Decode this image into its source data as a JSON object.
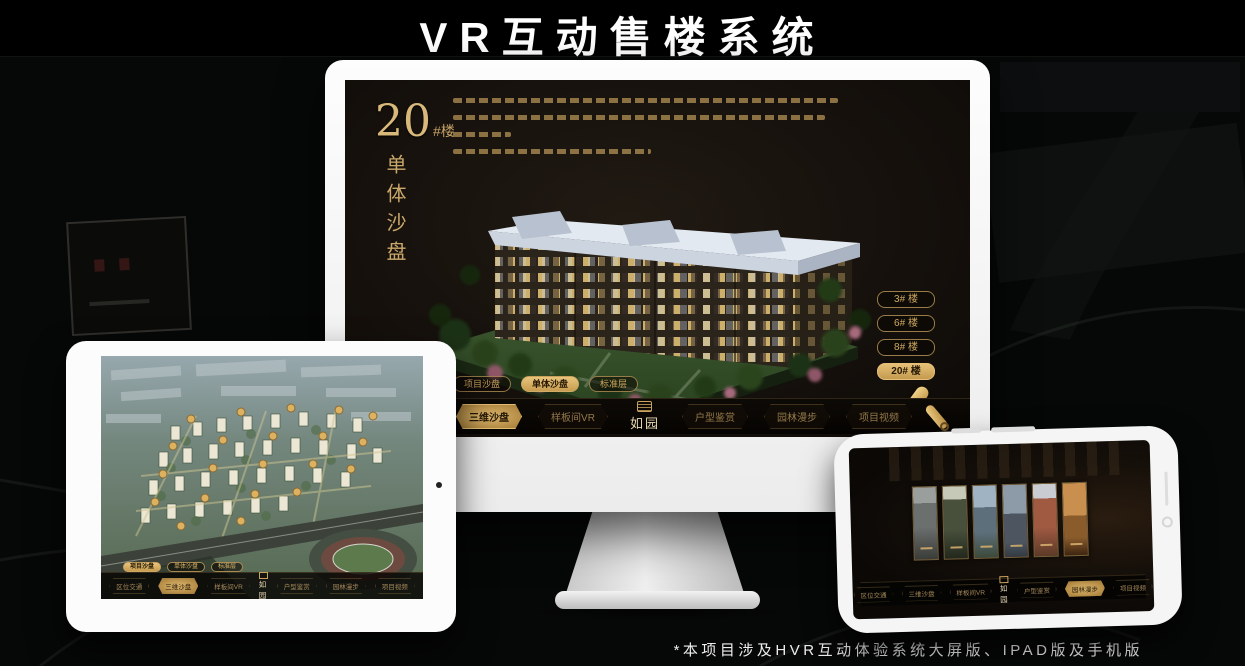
{
  "header": {
    "title": "VR互动售楼系统"
  },
  "footer": {
    "note": "*本项目涉及HVR互动体验系统大屏版、IPAD版及手机版"
  },
  "brand": {
    "logo": "如园",
    "gold": "#c9a35f",
    "screen_bg": "#17120e"
  },
  "nav": {
    "items": [
      "区位交通",
      "三维沙盘",
      "样板间VR",
      "户型鉴赏",
      "园林漫步",
      "项目视频"
    ],
    "scroll_icon": "scroll-collapse"
  },
  "tabs": {
    "items": [
      "项目沙盘",
      "单体沙盘",
      "标准层"
    ]
  },
  "monitor": {
    "heading_number": "20",
    "heading_suffix": "#楼",
    "heading_vertical": "单体沙盘",
    "floors": [
      "3# 楼",
      "6# 楼",
      "8# 楼",
      "20# 楼"
    ],
    "active_floor": "20# 楼",
    "active_tab": "单体沙盘",
    "active_nav": "三维沙盘"
  },
  "tablet": {
    "active_tab": "项目沙盘",
    "active_nav": "三维沙盘"
  },
  "phone": {
    "active_nav": "园林漫步",
    "panel_count": 6
  }
}
